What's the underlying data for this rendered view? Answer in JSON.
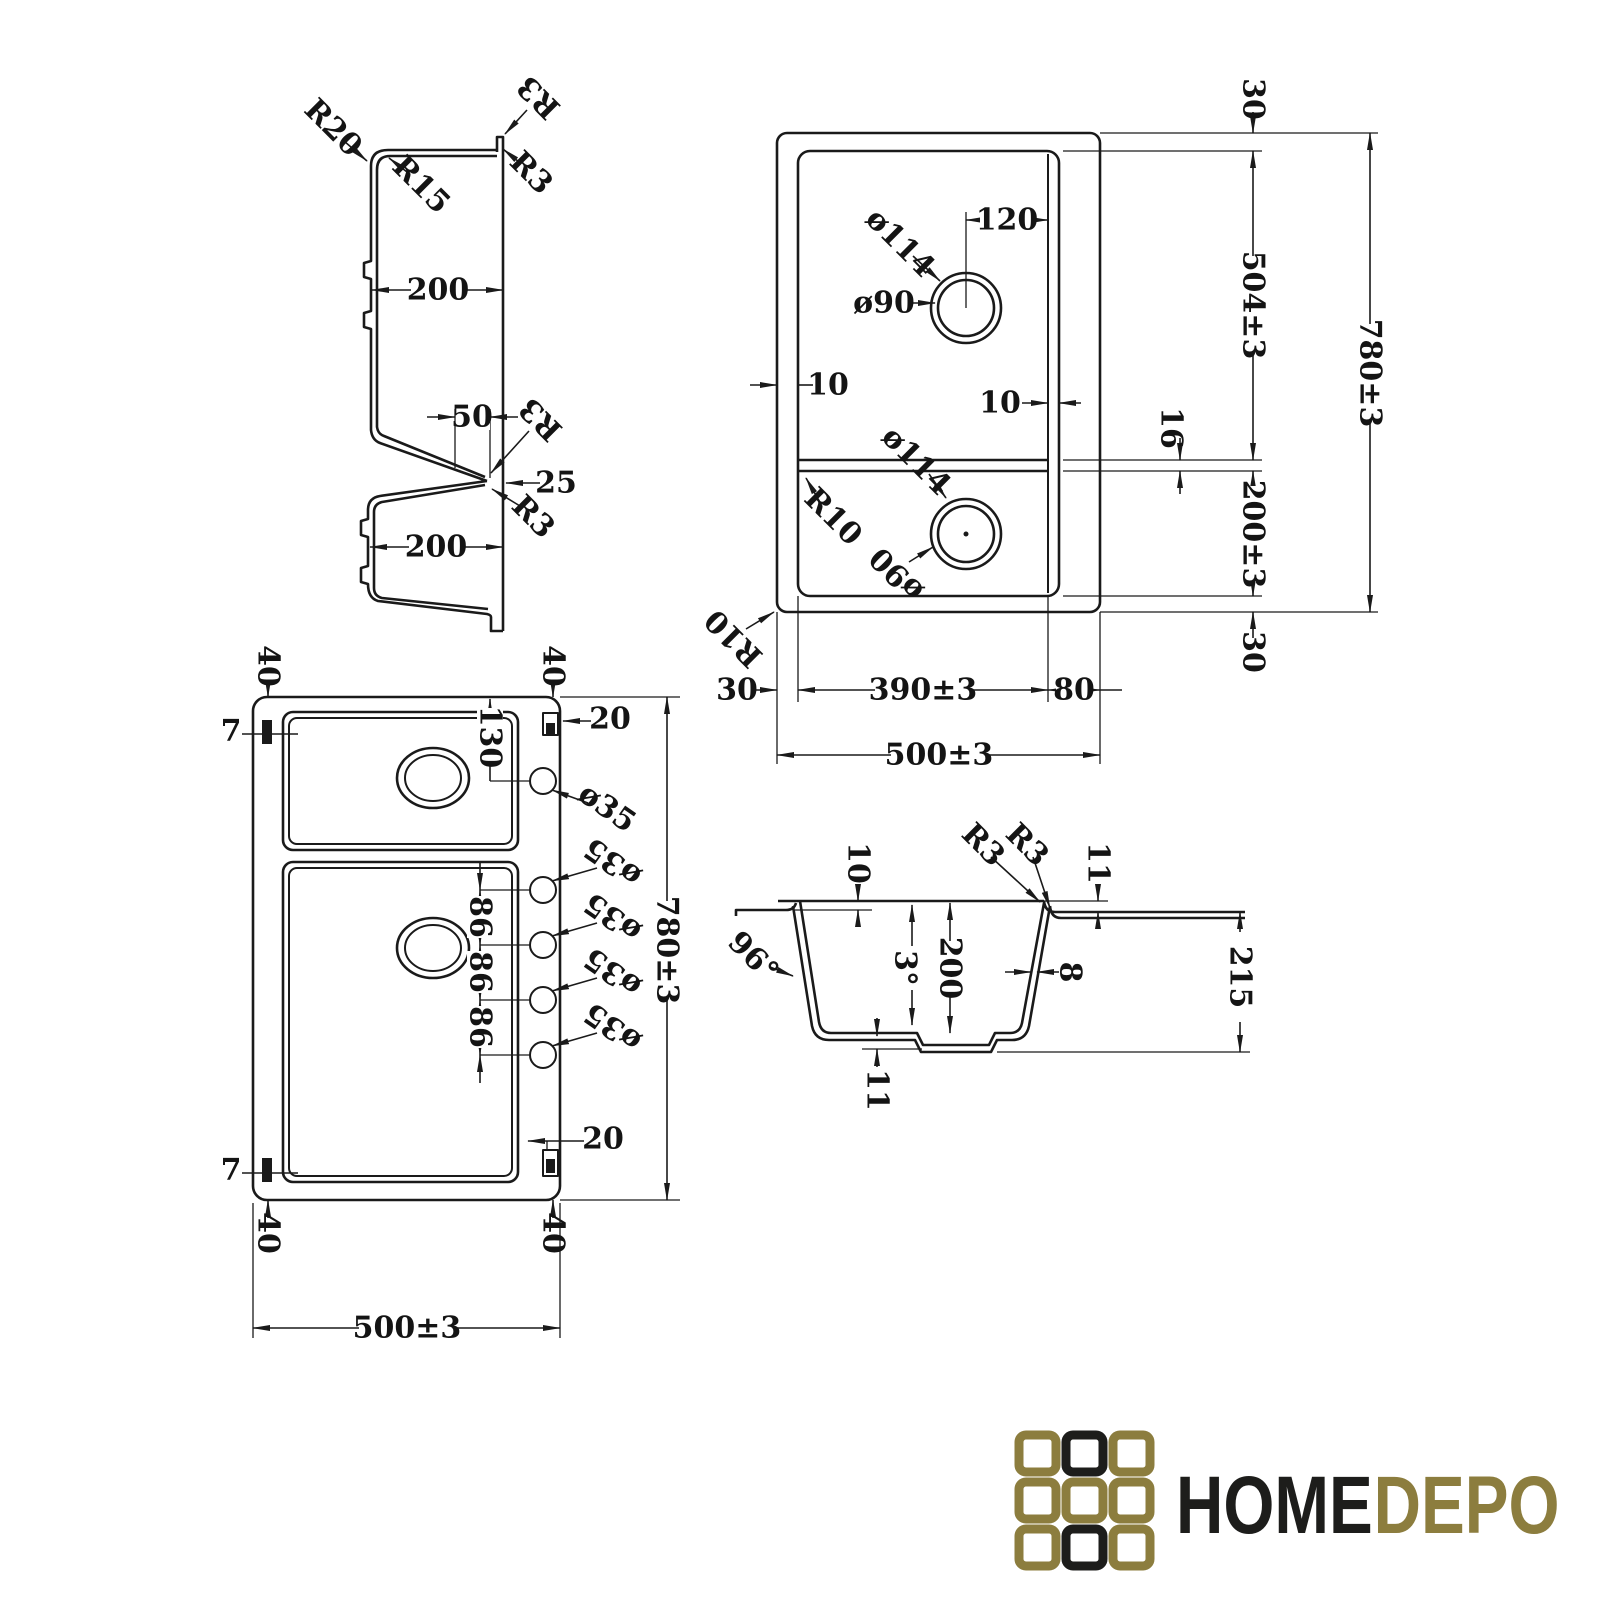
{
  "viewA": {
    "r20": "R20",
    "r15": "R15",
    "r3": "R3",
    "dim200": "200",
    "dim50": "50",
    "dim25": "25"
  },
  "viewB": {
    "dim30": "30",
    "dim120": "120",
    "dia114": "ø114",
    "dia90": "ø90",
    "dim504": "504±3",
    "dim780": "780±3",
    "dim10": "10",
    "dim16": "16",
    "r10": "R10",
    "dim200": "200±3",
    "dim390": "390±3",
    "dim80": "80",
    "dim500": "500±3"
  },
  "viewC": {
    "dim40": "40",
    "dim7": "7",
    "dim130": "130",
    "dim20": "20",
    "dia35": "ø35",
    "dim86": "86",
    "dim780": "780±3",
    "dim500": "500±3"
  },
  "viewD": {
    "dim10": "10",
    "r3": "R3",
    "dim11": "11",
    "deg96": "96°",
    "deg3": "3°",
    "dim200": "200",
    "dim8": "8",
    "dim215": "215"
  },
  "logo": {
    "home": "HOME",
    "depo": "DEPO",
    "gold": "#8c7d3e",
    "black": "#1d1d1b"
  }
}
